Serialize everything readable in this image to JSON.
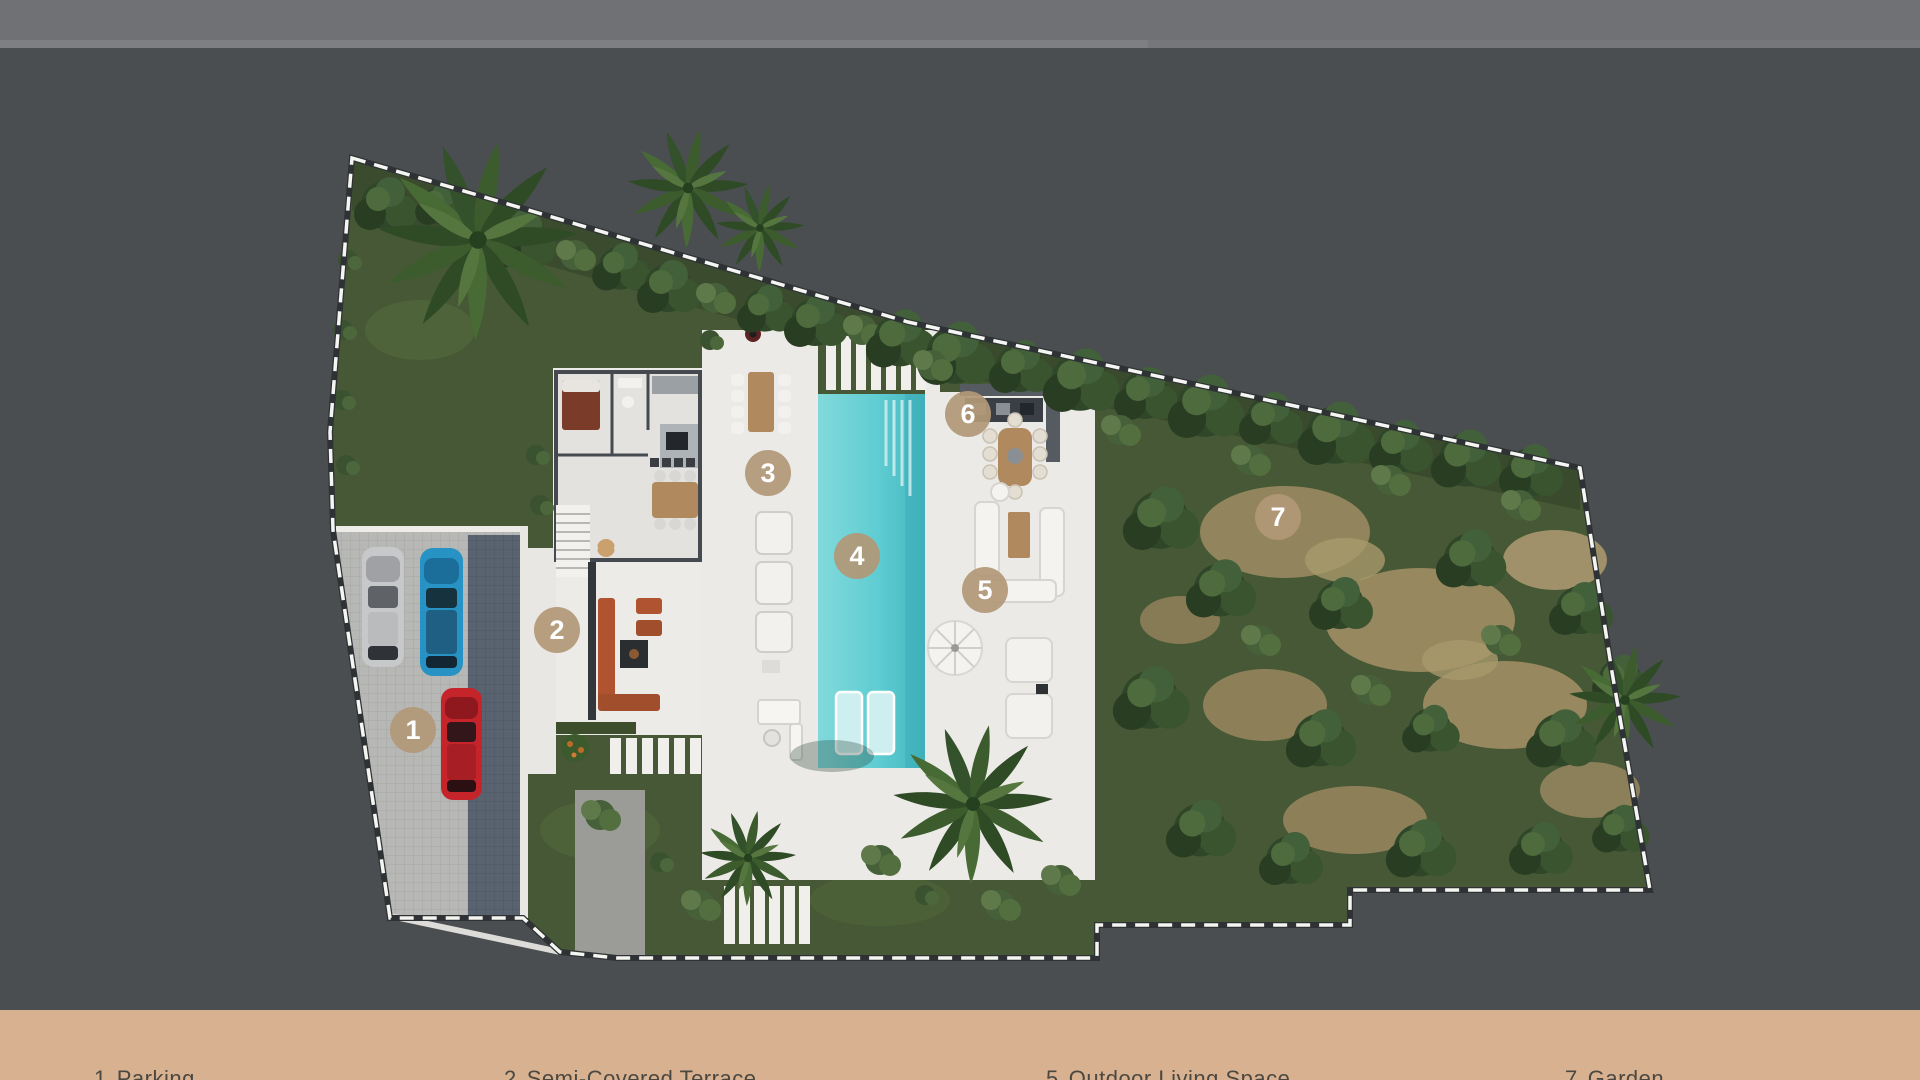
{
  "plan": {
    "title": "villa-site-plan-aerial-render",
    "marker_color": "#b29877",
    "marker_text_color": "#ffffff",
    "pool_color": "#5fcdd2",
    "markers": [
      {
        "number": "1"
      },
      {
        "number": "2"
      },
      {
        "number": "3"
      },
      {
        "number": "4"
      },
      {
        "number": "5"
      },
      {
        "number": "6"
      },
      {
        "number": "7"
      }
    ],
    "cars": [
      {
        "name": "silver-car",
        "color": "#c7c8ca"
      },
      {
        "name": "blue-car",
        "color": "#2792c4"
      },
      {
        "name": "red-car",
        "color": "#c6242b"
      }
    ]
  },
  "legend": {
    "bar_color": "#d8b290",
    "text_color": "#4b4741",
    "items": [
      {
        "number": "1",
        "label": "Parking"
      },
      {
        "number": "2",
        "label": "Semi-Covered Terrace"
      },
      {
        "number": "5",
        "label": "Outdoor Living Space"
      },
      {
        "number": "7",
        "label": "Garden"
      }
    ]
  }
}
